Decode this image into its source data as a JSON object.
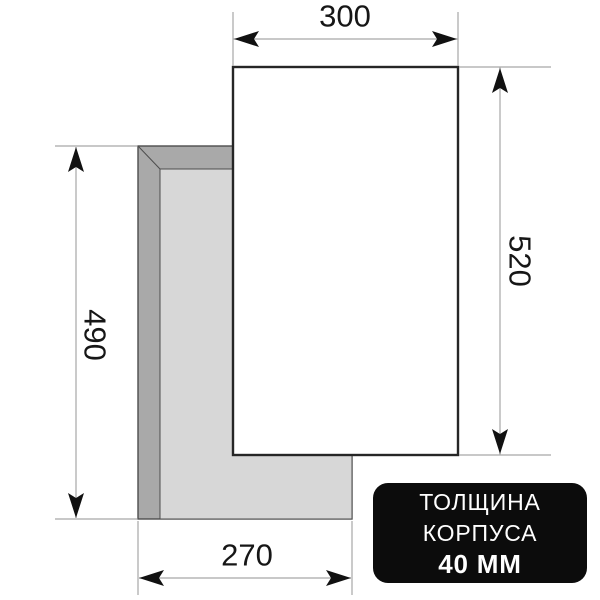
{
  "diagram": {
    "type": "appliance-installation-dimensions",
    "dimension_labels": {
      "panel_width": "300",
      "panel_height": "520",
      "body_height": "490",
      "body_width": "270"
    },
    "badge": {
      "line1": "ТОЛЩИНА",
      "line2": "КОРПУСА",
      "line3": "40 ММ"
    },
    "colors": {
      "body_side_gray": "#a9a9a9",
      "body_top_gray": "#d7d7d7",
      "panel_fill": "#ffffff",
      "panel_border": "#262626",
      "outline_gray": "#4d4d4d",
      "dim_line_gray": "#a6a6a6",
      "arrow_black": "#111111",
      "label_text": "#161616",
      "badge_background": "#0c0c0c",
      "badge_text": "#ffffff"
    }
  }
}
